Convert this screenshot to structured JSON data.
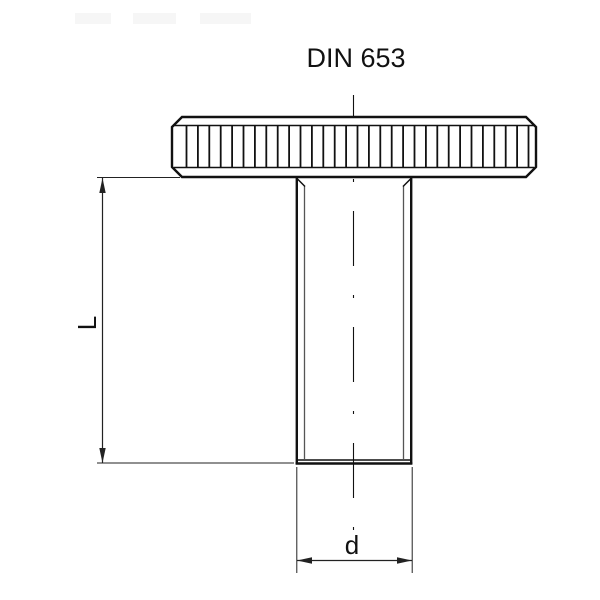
{
  "title": "DIN 653",
  "dimension_labels": {
    "length": "L",
    "diameter": "d"
  },
  "knurl": {
    "count": 31
  },
  "colors": {
    "line": "#111111",
    "thin_line": "#222222",
    "thread_line": "#555555",
    "background": "#ffffff"
  }
}
